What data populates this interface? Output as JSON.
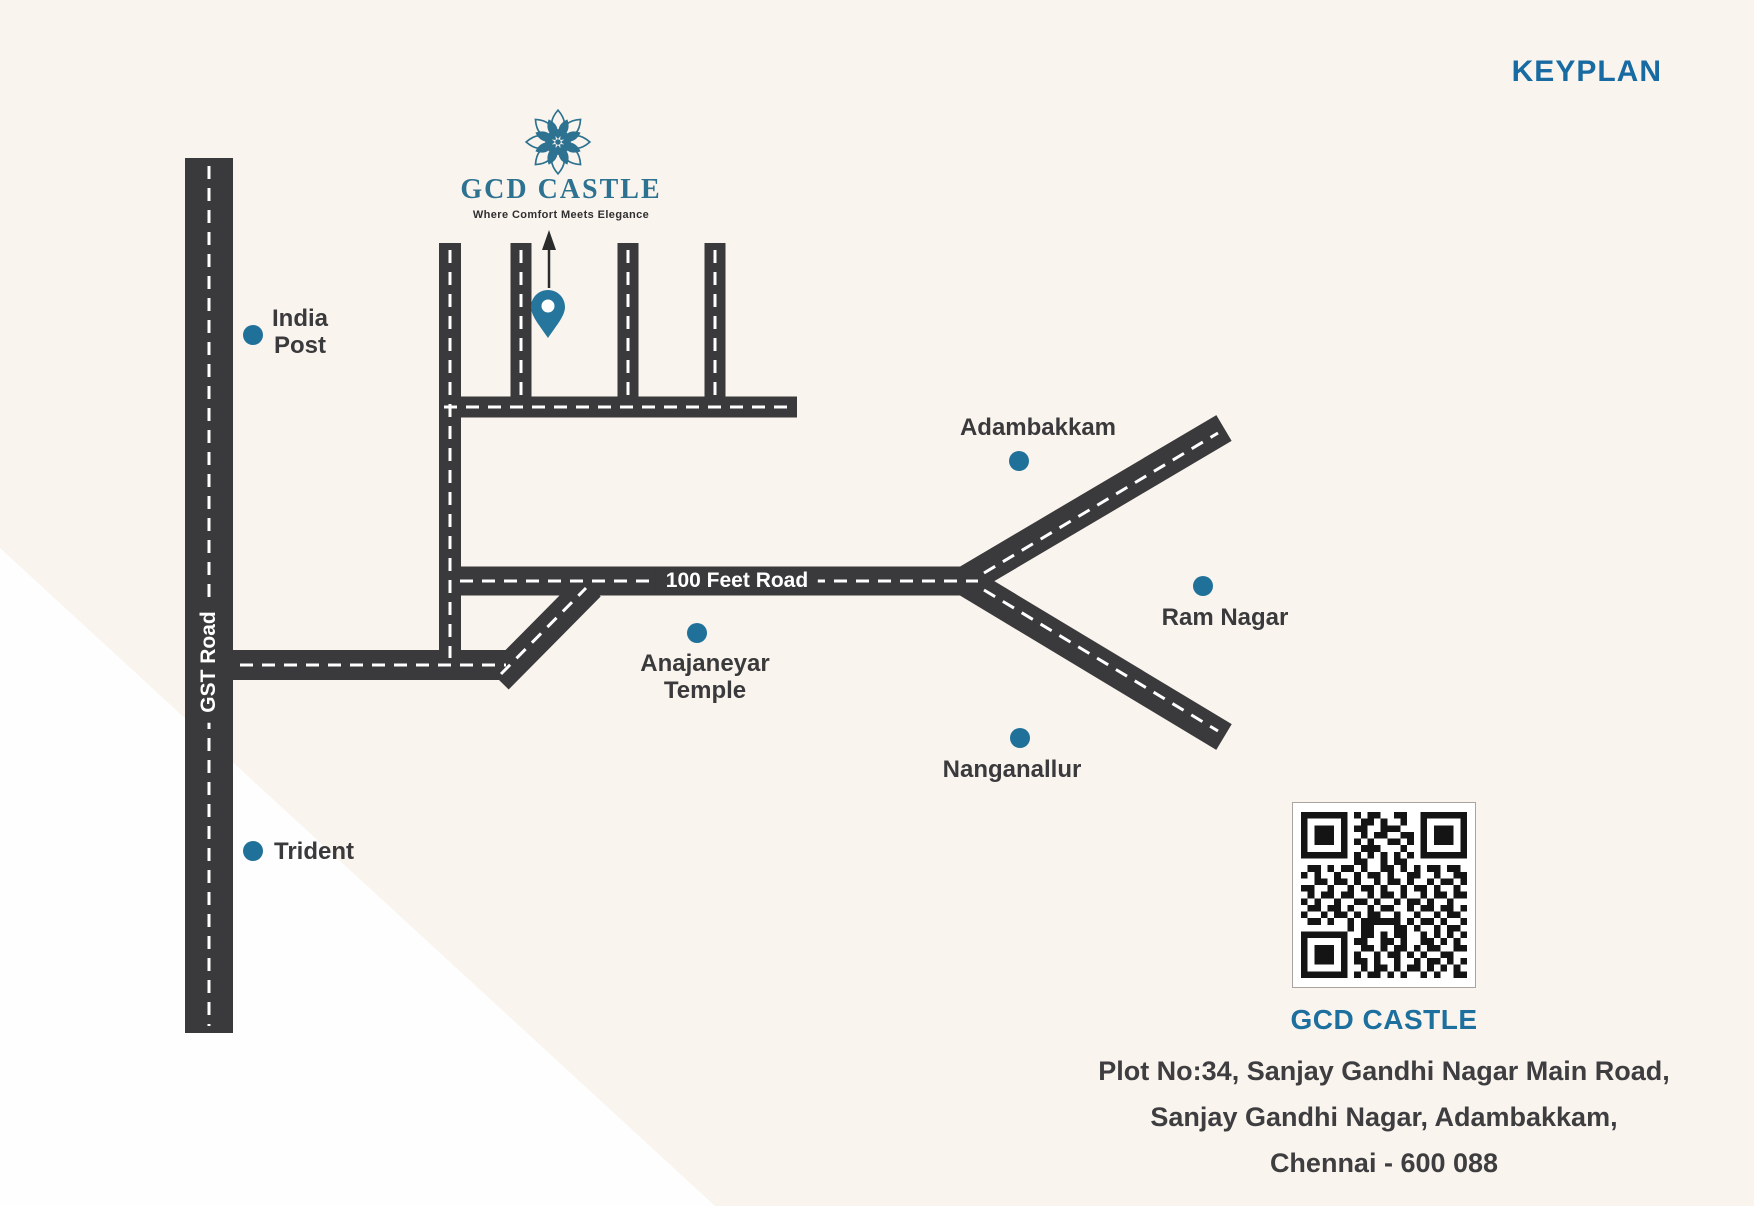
{
  "header": {
    "title": "KEYPLAN"
  },
  "logo": {
    "name": "GCD CASTLE",
    "tagline": "Where Comfort Meets Elegance"
  },
  "map": {
    "road_labels": {
      "gst": "GST Road",
      "feet": "100 Feet Road"
    },
    "landmarks": [
      {
        "id": "india-post",
        "lines": [
          "India",
          "Post"
        ]
      },
      {
        "id": "trident",
        "lines": [
          "Trident"
        ]
      },
      {
        "id": "anajaneyar-temple",
        "lines": [
          "Anajaneyar",
          "Temple"
        ]
      },
      {
        "id": "adambakkam",
        "lines": [
          "Adambakkam"
        ]
      },
      {
        "id": "ram-nagar",
        "lines": [
          "Ram Nagar"
        ]
      },
      {
        "id": "nanganallur",
        "lines": [
          "Nanganallur"
        ]
      }
    ]
  },
  "footer": {
    "qr_title": "GCD CASTLE",
    "address_lines": [
      "Plot No:34, Sanjay Gandhi Nagar Main Road,",
      "Sanjay Gandhi Nagar, Adambakkam,",
      "Chennai - 600 088"
    ]
  },
  "colors": {
    "background_cream": "#faf4ee",
    "background_white": "#fefefe",
    "road": "#3a393b",
    "road_dash": "#ffffff",
    "marker_teal": "#20719a",
    "logo_teal": "#2d7290",
    "keyplan_blue": "#186ba2",
    "footer_title_teal": "#1d6f9e",
    "label_dark": "#3a3a3c"
  },
  "qr": {
    "matrix": [
      "1111111010110011001111111",
      "1000001001101001001000001",
      "1011101011001110001011101",
      "1011101001011001101011101",
      "1011101010100110101011101",
      "1000001001110001001000001",
      "1111111010101010101111111",
      "0000000011001011000000000",
      "0110101101001101010110110",
      "1010010010110100110010011",
      "0011011010010110100101101",
      "1100100101101001011010010",
      "0101101100101101001011011",
      "1010010011010010110100100",
      "0110110100101100101101101",
      "1001011010110010010010110",
      "0110100101111110101101001",
      "0000000101100011010010110",
      "1111111001101011001010101",
      "1000001011001101001101010",
      "1011101001101011010110011",
      "1011101010010110101001100",
      "1011101011010010010110101",
      "1000001001011010110101010",
      "1111111010110101001010011"
    ]
  }
}
